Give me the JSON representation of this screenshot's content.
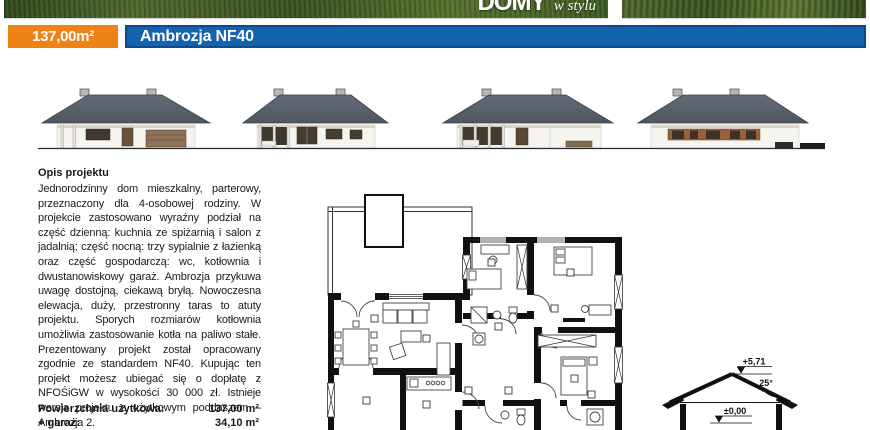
{
  "banner": {
    "logo_main": "DOMY",
    "logo_script": "w stylu"
  },
  "header": {
    "area_badge": "137,00m²",
    "project_name": "Ambrozja NF40"
  },
  "description": {
    "heading": "Opis projektu",
    "body": "Jednorodzinny dom mieszkalny, parterowy, przeznaczony dla 4-osobowej rodziny. W projekcie zastosowano wyraźny podział na część dzienną: kuchnia ze spiżarnią i salon z jadalnią; część nocną: trzy sypialnie z łazienką oraz część gospodarczą: wc, kotłownia i dwustanowiskowy garaż. Ambrozja przykuwa uwagę dostojną, ciekawą bryłą. Nowoczesna elewacja, duży, przestronny taras to atuty projektu. Sporych rozmiarów kotłownia umożliwia zastosowanie kotła na paliwo stałe. Prezentowany projekt został opracowany zgodnie ze standardem NF40. Kupując ten projekt możesz ubiegać się o dopłatę z NFOŚiGW w wysokości 30 000 zł. Istnieje wersja projektu z użytkowym poddaszem – Ambrozja 2."
  },
  "areas": {
    "rows": [
      {
        "label": "Powierzchnia użytkowa:",
        "value": "137,00 m²"
      },
      {
        "label": "+ garaż:",
        "value": "34,10 m²"
      }
    ]
  },
  "section_labels": {
    "ridge_level": "+5,71",
    "roof_angle": "25°",
    "floor_level": "±0,00"
  },
  "colors": {
    "accent_orange": "#ee8214",
    "accent_blue": "#1563ae",
    "roof_gray": "#59626d"
  }
}
